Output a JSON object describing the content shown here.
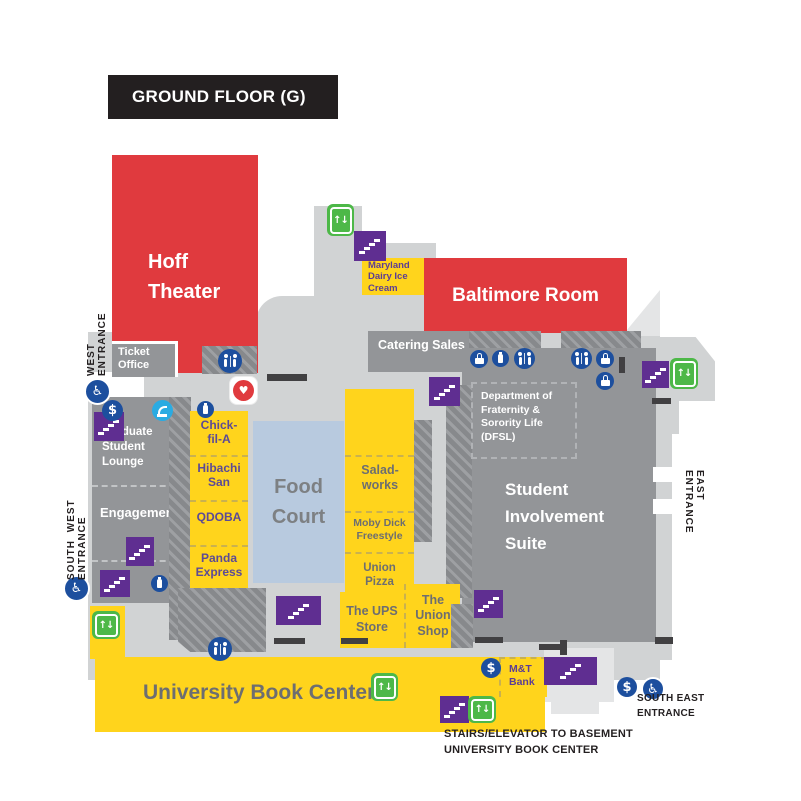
{
  "title": "GROUND FLOOR (G)",
  "rooms": {
    "hoff_theater": "Hoff Theater",
    "ticket_office": "Ticket Office",
    "baltimore_room": "Baltimore Room",
    "catering_sales": "Catering Sales",
    "maryland_dairy": "Maryland Dairy Ice Cream",
    "dfsl": "Department of Fraternity & Sorority Life (DFSL)",
    "graduate_student_lounge": "Graduate Student Lounge",
    "engagement": "Engagement",
    "student_involvement_suite": "Student Involvement Suite",
    "food_court": "Food Court",
    "chick_fil_a": "Chick-fil-A",
    "hibachi_san": "Hibachi San",
    "qdoba": "QDOBA",
    "panda_express": "Panda Express",
    "saladworks": "Salad-works",
    "moby_dick_freestyle": "Moby Dick Freestyle",
    "union_pizza": "Union Pizza",
    "ups_store": "The UPS Store",
    "union_shop": "The Union Shop",
    "university_book_center": "University Book Center",
    "mt_bank": "M&T Bank"
  },
  "entrances": {
    "west": "WEST ENTRANCE",
    "south_west": "SOUTH WEST ENTRANCE",
    "east": "EAST ENTRANCE",
    "south_east": "SOUTH EAST ENTRANCE"
  },
  "notes": {
    "basement_access": "STAIRS/ELEVATOR TO BASEMENT UNIVERSITY BOOK CENTER"
  },
  "icons": {
    "elevator_glyph": "↑↓",
    "dollar_glyph": "$",
    "accessible_glyph": "♿",
    "aed_glyph": "♥"
  },
  "palette": {
    "red": "#e03a3e",
    "yellow": "#ffd41c",
    "room_gray": "#939598",
    "floor_gray": "#d1d3d4",
    "stairs_purple": "#5f2e91",
    "elevator_green": "#4db848",
    "icon_blue": "#1d4f9e",
    "fountain_cyan": "#2aabe2",
    "food_court_blue": "#b8cadf",
    "header_black": "#231f20"
  }
}
